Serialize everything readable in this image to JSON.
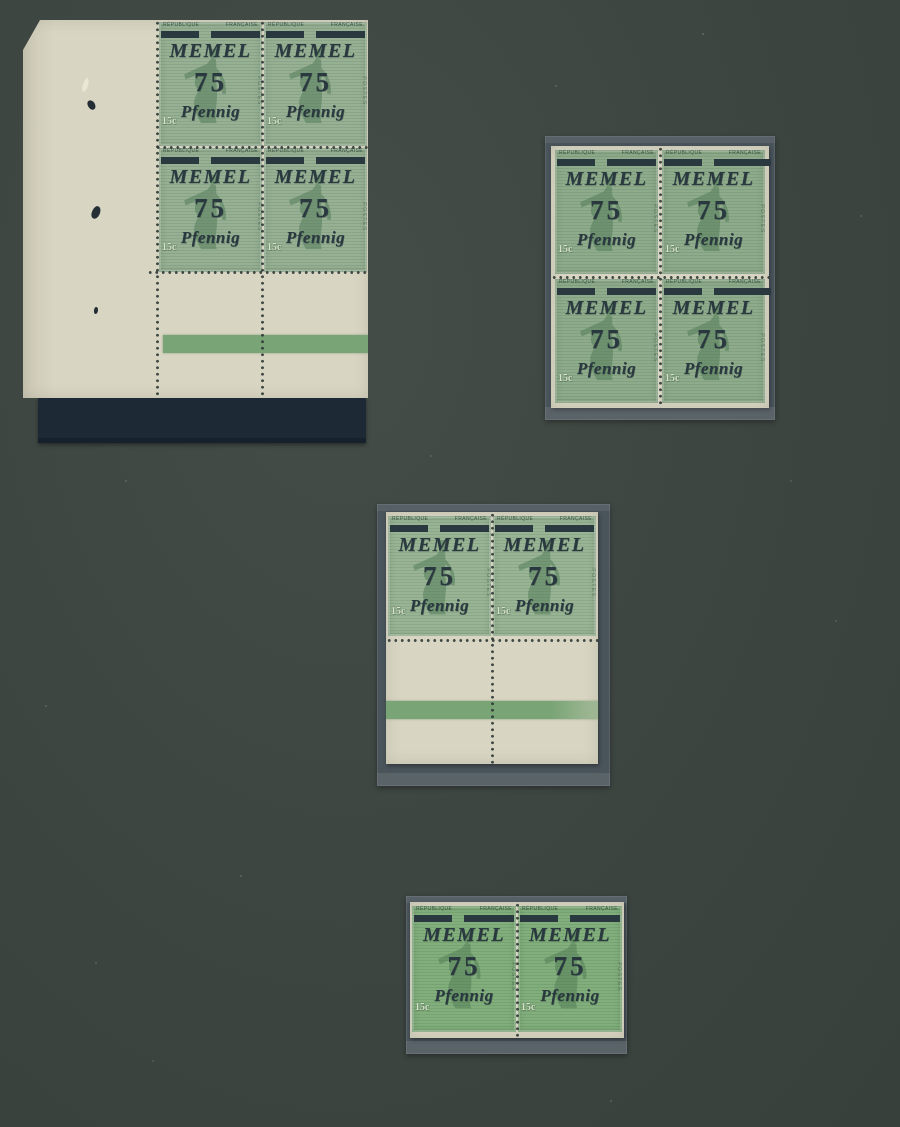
{
  "page": {
    "kind": "stamp-album-page-photo"
  },
  "colors": {
    "page_background": "#3d4541",
    "page_background_light": "#444d48",
    "page_background_edge": "#38403c",
    "paper_cream": "#d9d5c3",
    "paper_cream_dark": "#ccc8b5",
    "mount_gray": "#4a545b",
    "shadow_strip": "#1d2a36",
    "stamp_green_1": "#95af92",
    "stamp_green_2": "#8caa89",
    "stamp_green_3": "#96b392",
    "stamp_green_4": "#80ad7a",
    "overprint_ink": "#2a3840",
    "band_green": "#79a476",
    "perf_dot": "#2f3a37",
    "figure_green": "#4f7a55"
  },
  "stamp": {
    "top_left_text": "RÉPUBLIQUE",
    "top_right_text": "FRANÇAISE",
    "overprint_name": "MEMEL",
    "overprint_value": "75",
    "overprint_currency": "Pfennig",
    "denomination": "15c",
    "side_text": "POSTES"
  },
  "items": [
    {
      "label": "corner block of four with left and bottom selvage and green plate band",
      "stamp_count": 4
    },
    {
      "label": "block of four on mount",
      "stamp_count": 4
    },
    {
      "label": "horizontal pair with bottom gutter margin and green plate band",
      "stamp_count": 2
    },
    {
      "label": "horizontal pair on mount",
      "stamp_count": 2
    }
  ]
}
